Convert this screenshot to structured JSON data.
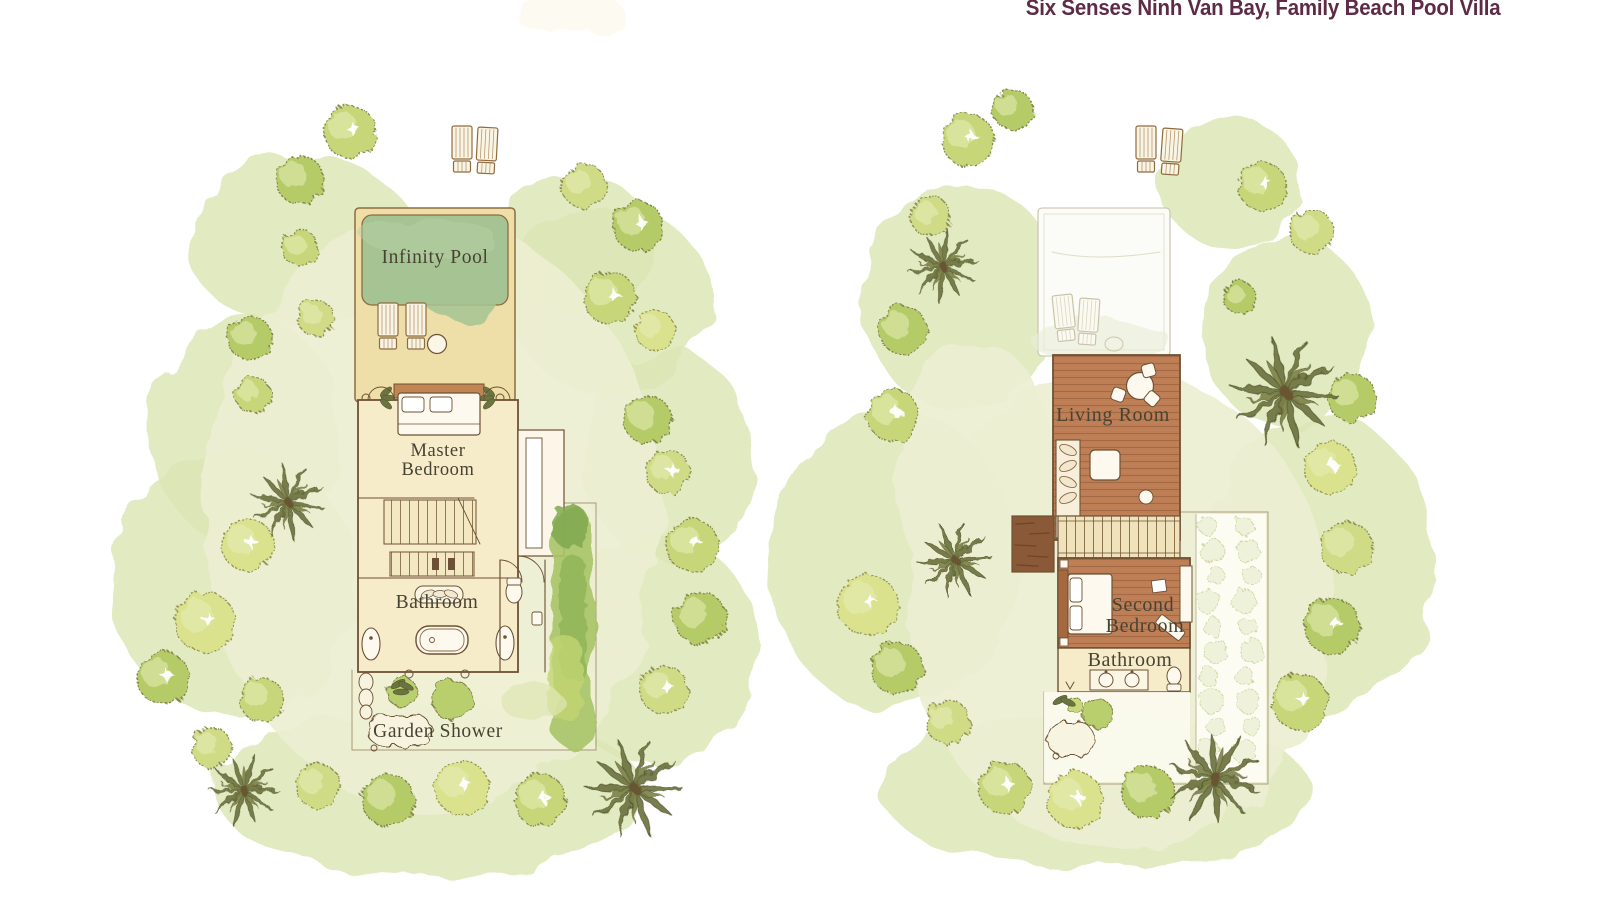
{
  "title": "Six Senses Ninh Van Bay, Family Beach Pool Villa",
  "plans": {
    "ground": {
      "labels": {
        "infinity_pool": "Infinity Pool",
        "master_bedroom_1": "Master",
        "master_bedroom_2": "Bedroom",
        "bathroom": "Bathroom",
        "garden_shower": "Garden Shower"
      }
    },
    "upper": {
      "labels": {
        "living_room": "Living Room",
        "second_bedroom_1": "Second",
        "second_bedroom_2": "Bedroom",
        "bathroom": "Bathroom"
      }
    }
  },
  "colors": {
    "title_text": "#5d2b45",
    "label_text": "#474334",
    "pool_green": "#a6c493",
    "deck_tan": "#eedfa9",
    "room_cream": "#f7ecca",
    "wood_brown": "#bd7e55",
    "ink_brown": "#6d5134",
    "foliage_green": "#c6d678",
    "wash_green": "#dce6b4"
  }
}
